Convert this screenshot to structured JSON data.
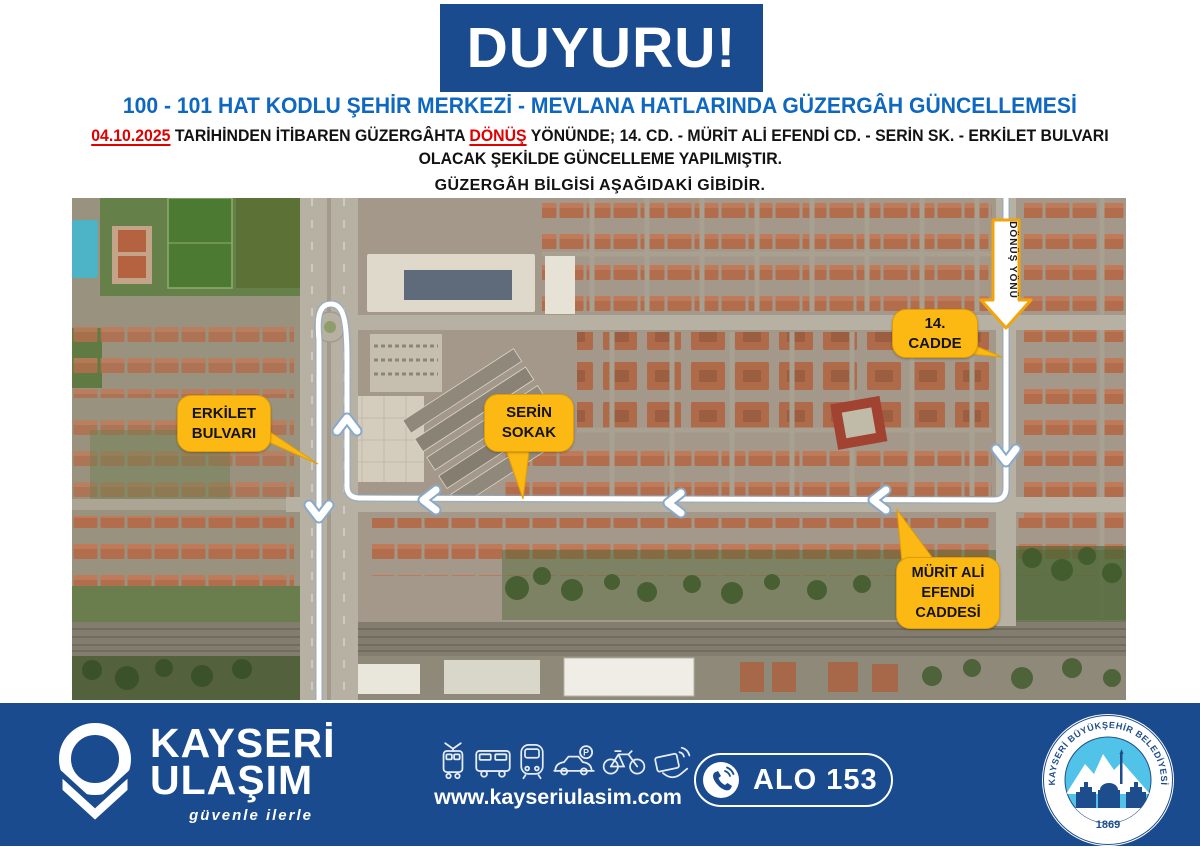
{
  "banner": {
    "title": "DUYURU!"
  },
  "headline": "100 - 101 HAT KODLU ŞEHİR MERKEZİ - MEVLANA HATLARINDA GÜZERGÂH GÜNCELLEMESİ",
  "notice": {
    "date": "04.10.2025",
    "text_after_date": " TARİHİNDEN İTİBAREN GÜZERGÂHTA ",
    "highlight": "DÖNÜŞ",
    "text_after_highlight": " YÖNÜNDE; 14. CD. - MÜRİT ALİ EFENDİ CD. - SERİN SK. - ERKİLET BULVARI",
    "line2": "OLACAK ŞEKİLDE GÜNCELLEME YAPILMIŞTIR.",
    "subheading": "GÜZERGÂH BİLGİSİ AŞAĞIDAKİ GİBİDİR."
  },
  "map": {
    "direction_arrow_label": "DÖNÜŞ YÖNÜ",
    "labels": {
      "cadde14": {
        "line1": "14.",
        "line2": "CADDE"
      },
      "erkilet": {
        "line1": "ERKİLET",
        "line2": "BULVARI"
      },
      "serin": {
        "line1": "SERİN",
        "line2": "SOKAK"
      },
      "murit": {
        "line1": "MÜRİT ALİ",
        "line2": "EFENDİ",
        "line3": "CADDESİ"
      }
    }
  },
  "footer": {
    "brand_line1": "KAYSERİ",
    "brand_line2": "ULAŞIM",
    "slogan": "güvenle ilerle",
    "website": "www.kayseriulasim.com",
    "hotline_label": "ALO 153",
    "parking_letter": "P",
    "icons": [
      "tram-icon",
      "bus-icon",
      "metro-icon",
      "car-parking-icon",
      "bicycle-icon",
      "contactless-card-icon"
    ],
    "seal": {
      "text": "KAYSERİ BÜYÜKŞEHİR BELEDİYESİ",
      "year": "1869"
    }
  },
  "colors": {
    "primary_blue": "#1a4b8e",
    "headline_blue": "#0e68c0",
    "alert_red": "#e00000",
    "label_yellow": "#fdb913"
  }
}
